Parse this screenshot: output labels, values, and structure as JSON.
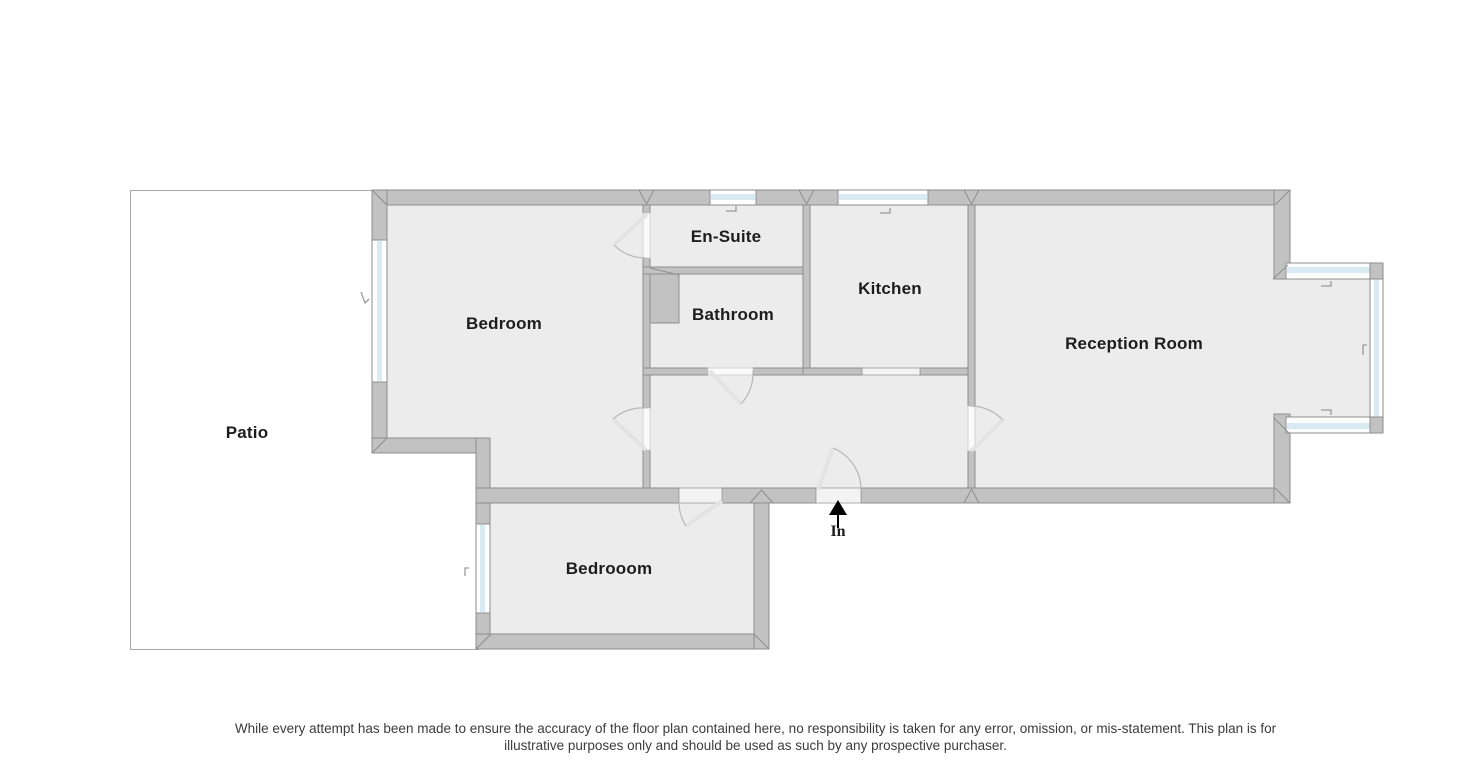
{
  "rooms": [
    {
      "id": "patio",
      "label": "Patio"
    },
    {
      "id": "bedroom",
      "label": "Bedroom"
    },
    {
      "id": "ensuite",
      "label": "En-Suite"
    },
    {
      "id": "bathroom",
      "label": "Bathroom"
    },
    {
      "id": "kitchen",
      "label": "Kitchen"
    },
    {
      "id": "reception",
      "label": "Reception Room"
    },
    {
      "id": "bedrooom",
      "label": "Bedrooom"
    }
  ],
  "entrance": {
    "label": "In"
  },
  "disclaimer": {
    "line1": "While every attempt has been made to ensure the accuracy of the floor plan contained here, no responsibility is taken for any error, omission, or mis-statement. This plan is for",
    "line2": "illustrative purposes only and should be used as such by any prospective purchaser."
  },
  "colors": {
    "background": "#ffffff",
    "wall_fill": "#c2c2c2",
    "wall_stroke": "#8e8e8e",
    "floor": "#ececec",
    "glass": "#d9eaf3",
    "door_gap": "#fafafa",
    "door_gap_ext": "#f3f3f3",
    "arc": "#b6b6b6",
    "leaf": "#e3e3e3",
    "tick": "#9a9a9a",
    "label": "#1d1d1d",
    "disclaimer": "#3c3c3c",
    "patio_border": "#a8a8a8",
    "arrow": "#000000"
  }
}
